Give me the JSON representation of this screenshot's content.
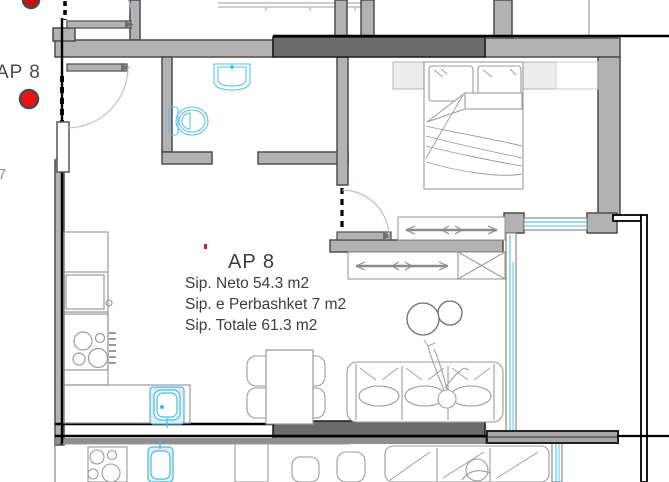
{
  "plan": {
    "marker_left": {
      "label": "AP 8",
      "side_note": "7"
    },
    "info_block": {
      "title": "AP 8",
      "area_neto": "Sip. Neto 54.3 m2",
      "area_shared": "Sip. e Perbashket 7 m2",
      "area_total": "Sip. Totale 61.3 m2"
    },
    "icons": [
      "red-marker",
      "bed",
      "pillow",
      "wardrobe-clothes-rail",
      "shelf-x-unit",
      "sofa",
      "person-figure",
      "coffee-tables",
      "dining-table",
      "dining-chair",
      "kitchen-stove",
      "kitchen-sink",
      "bathroom-sink",
      "toilet",
      "door-swing-arc",
      "window-glazing"
    ],
    "colors": {
      "wall_light": "#b2b2b2",
      "wall_dark": "#6b6b6b",
      "wall_outline": "#4c4c4c",
      "structure_black": "#000000",
      "furniture_line": "#9a9a9a",
      "fixture_cyan": "#56c3e8",
      "door_arc_purple": "#c5b3e6",
      "marker_red": "#e51212",
      "text_gray": "#3d3d3d"
    }
  }
}
